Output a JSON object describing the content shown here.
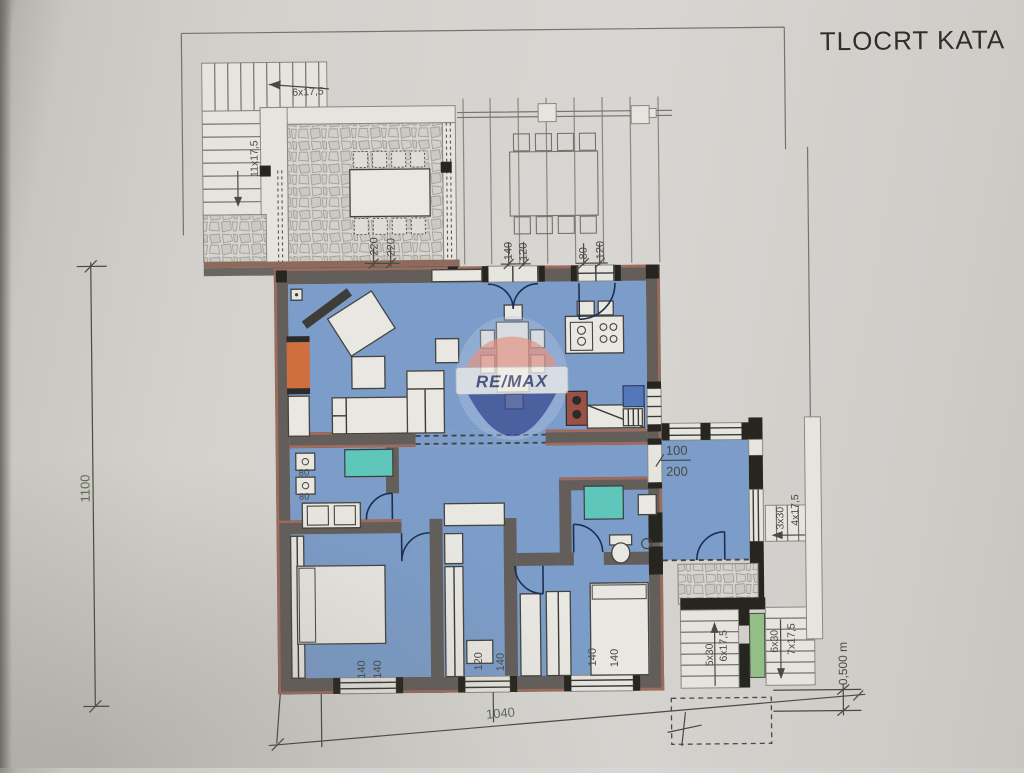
{
  "title": "TLOCRT KATA",
  "watermark": {
    "brand": "RE/MAX"
  },
  "colors": {
    "floor_blue": "#7c9dc9",
    "shower_teal": "#5ec6ba",
    "fireplace_orange": "#cf6f3d",
    "stair_green": "#92bf85",
    "wall_gray": "#635e5a",
    "wall_accent": "#a06b5c",
    "remax_red": "#e09a8f",
    "remax_blue": "#3c4f94",
    "dim_green": "#5c6b52"
  },
  "labels": {
    "stairs_top": "6x17,5",
    "stairs_left": "11x17,5",
    "terrace_width_1": "220",
    "terrace_width_2": "220",
    "win_top1_a": "140",
    "win_top1_b": "120",
    "win_top2_a": "80",
    "win_top2_b": "120",
    "door_right_w": "100",
    "door_right_h": "200",
    "bath_80a": "80",
    "bath_80b": "80",
    "win_b1_a": "140",
    "win_b1_b": "140",
    "win_b2_a": "120",
    "win_b2_b": "140",
    "win_b3_a": "140",
    "win_b3_b": "140",
    "stairs_small_a": "3x30",
    "stairs_small_b": "4x17,5",
    "stairs_low_left_a": "5x30",
    "stairs_low_left_b": "6x17,5",
    "stairs_low_right_a": "6x30",
    "stairs_low_right_b": "7x17,5",
    "dim_total_width": "1040",
    "dim_total_height": "1100",
    "dim_offset": "0,500 m"
  }
}
